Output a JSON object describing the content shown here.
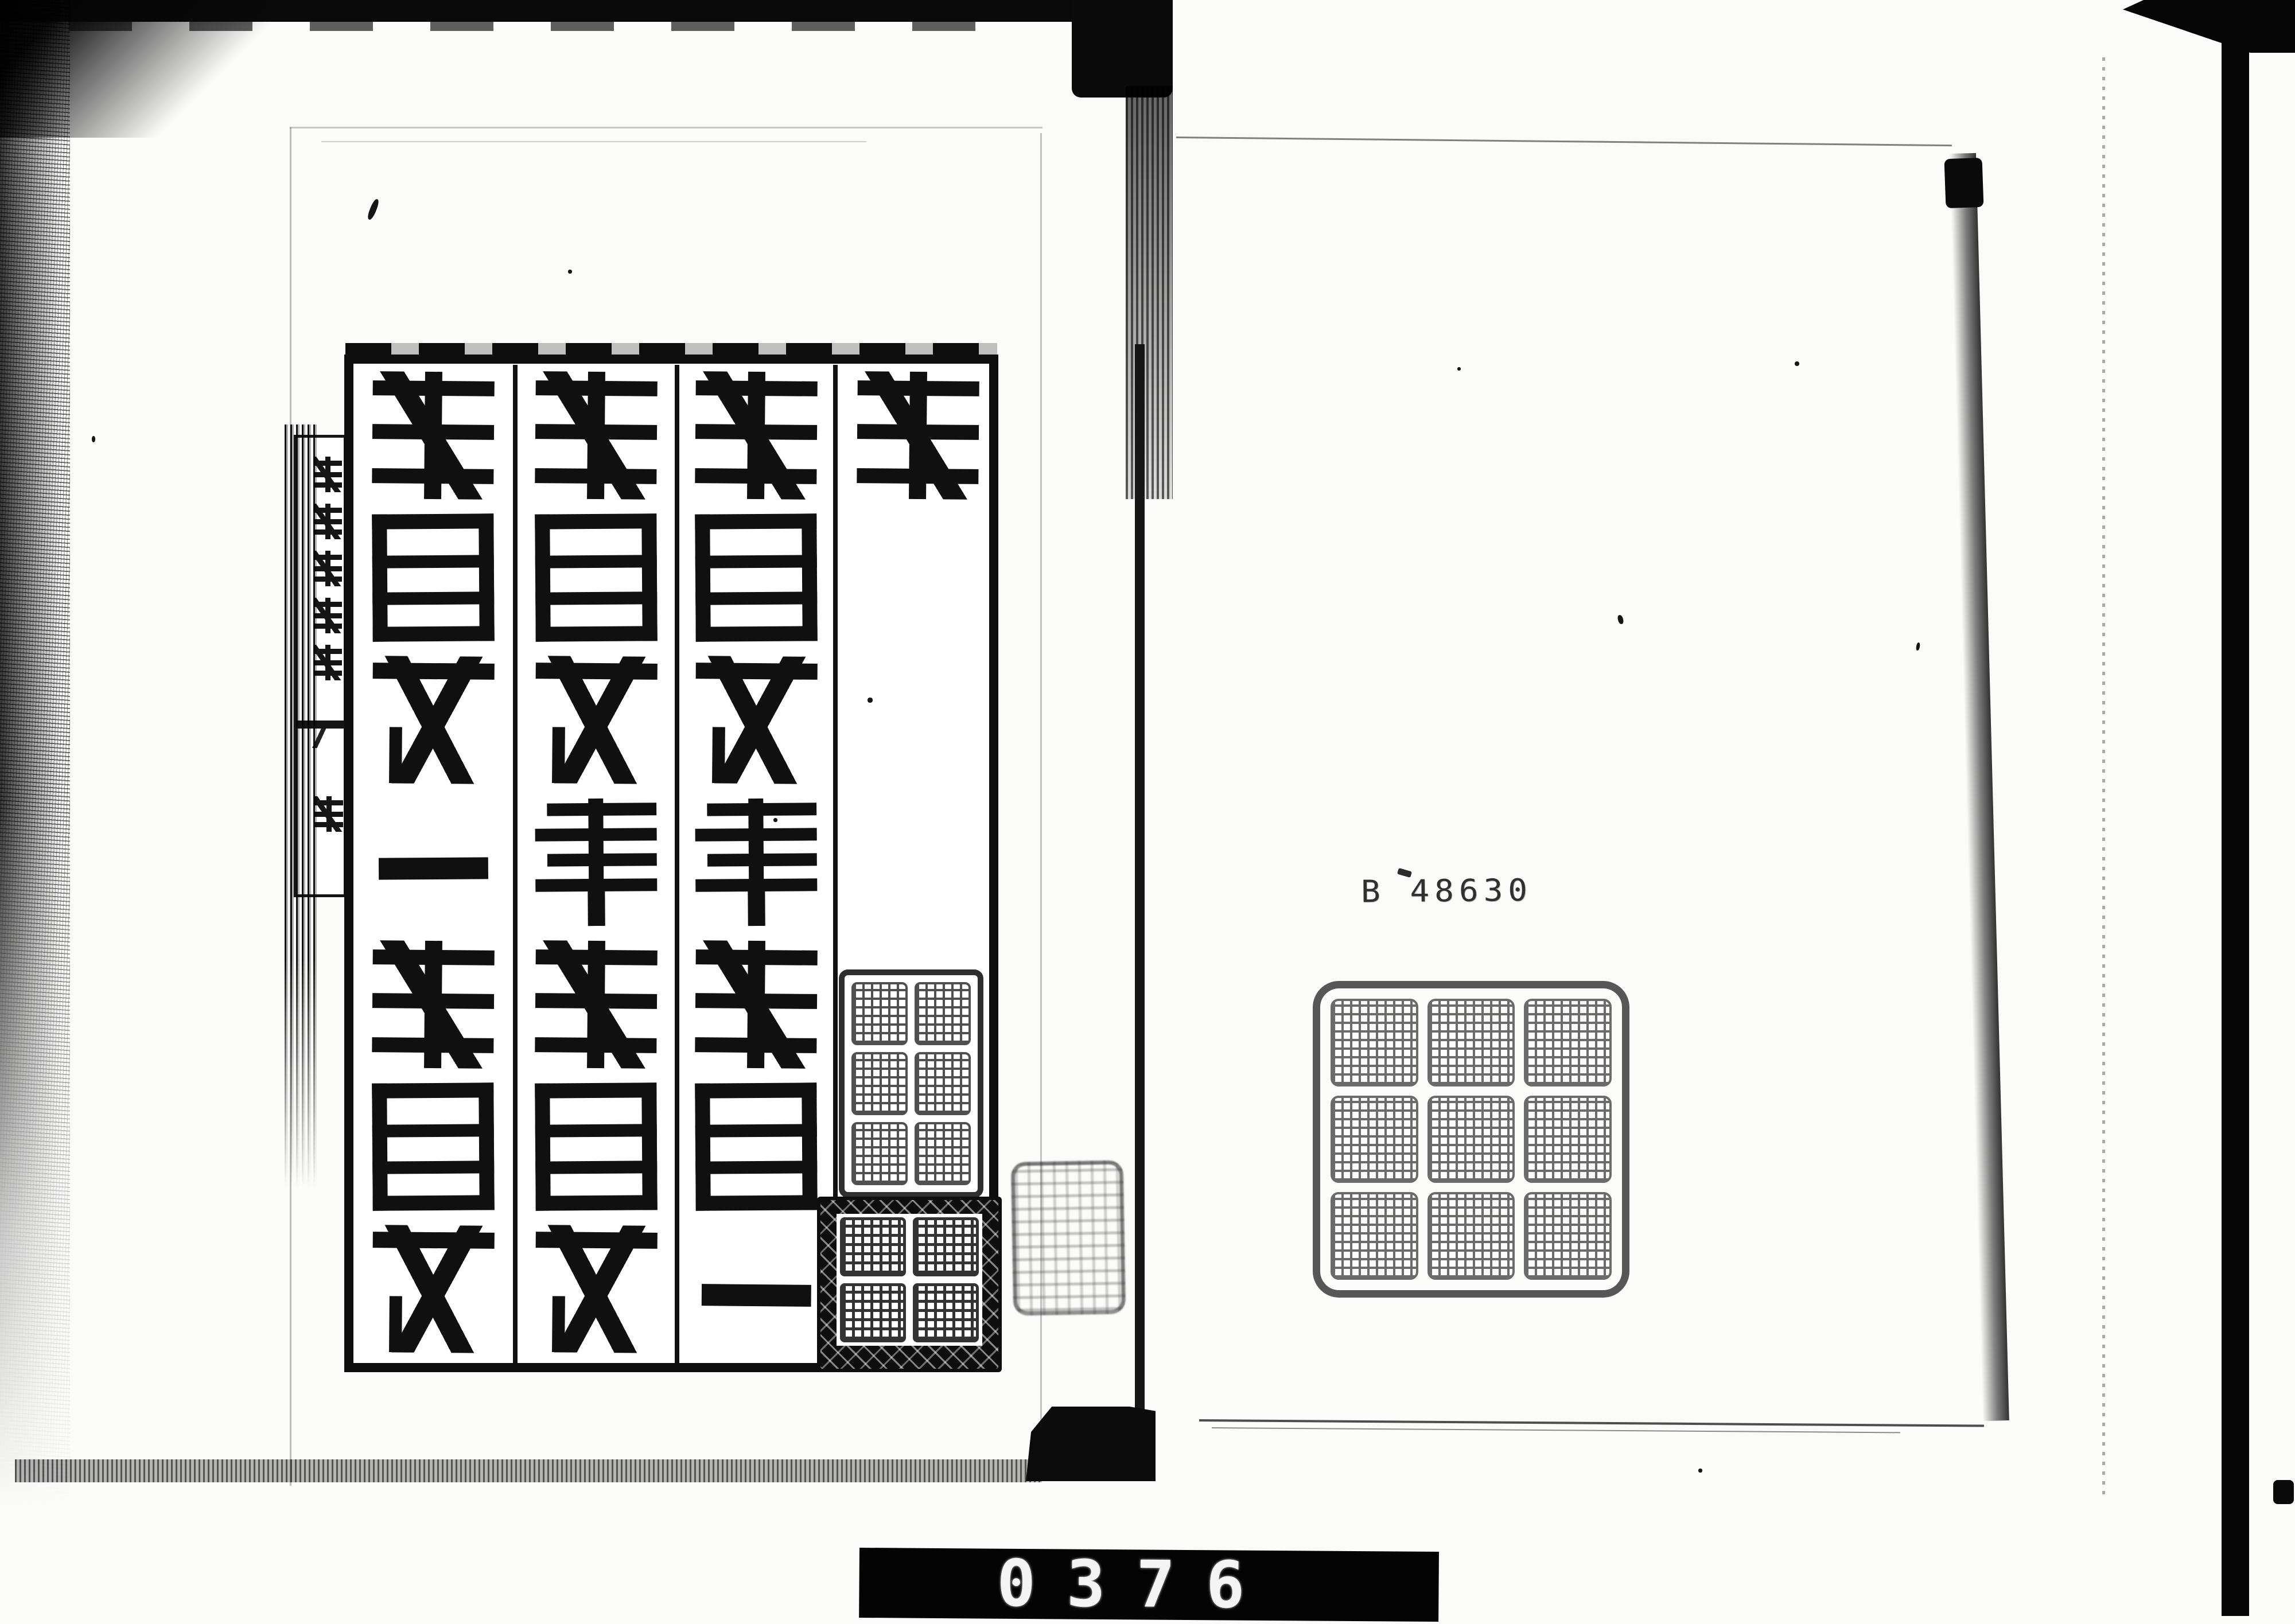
{
  "palette": {
    "ink": "#0b0b0b",
    "paper": "#ffffff",
    "seal_gray": "#4a4a4a",
    "stamp_gray": "#2f2f2f"
  },
  "left_page": {
    "spine_label": {
      "title_chars": [
        "綱",
        "鑑",
        "易",
        "知",
        "錄"
      ],
      "title": "綱鑑易知錄",
      "section_char": [
        "敘"
      ]
    },
    "main_text": {
      "passage_right_to_left": "敘　繼春秋而後大一統而明予奪者莫過綱目一書然而",
      "columns_right_to_left": [
        {
          "chars": [
            "敘"
          ]
        },
        {
          "chars": [
            "繼",
            "春",
            "秋",
            "而",
            "後",
            "大",
            "一"
          ]
        },
        {
          "chars": [
            "統",
            "而",
            "明",
            "予",
            "奪",
            "者",
            "莫"
          ]
        },
        {
          "chars": [
            "過",
            "綱",
            "目",
            "一",
            "書",
            "然",
            "而"
          ]
        }
      ]
    },
    "seals": {
      "rect_library_seal": {
        "grid": "2x3",
        "cells": [
          "國",
          "大",
          "學",
          "圖",
          "書",
          "館"
        ],
        "legibility": "faint seal script"
      },
      "nanki_bunko_seal": {
        "grid": "2x2",
        "cells": [
          "南",
          "葵",
          "文",
          "庫"
        ],
        "reading": "南葵文庫",
        "border": "ornate scrollwork"
      },
      "gutter_stamp": {
        "shape": "rounded square",
        "legibility": "illegible, very faint"
      }
    }
  },
  "right_page": {
    "call_number_stamp": "B 48630",
    "library_seal": {
      "grid": "3x3",
      "cells": [
        "東",
        "京",
        "帝",
        "國",
        "大",
        "學",
        "圖",
        "書",
        "印"
      ],
      "reading": "東京帝國大學圖書印",
      "legibility": "faint seal script"
    }
  },
  "microfilm": {
    "frame_counter": "0376"
  }
}
